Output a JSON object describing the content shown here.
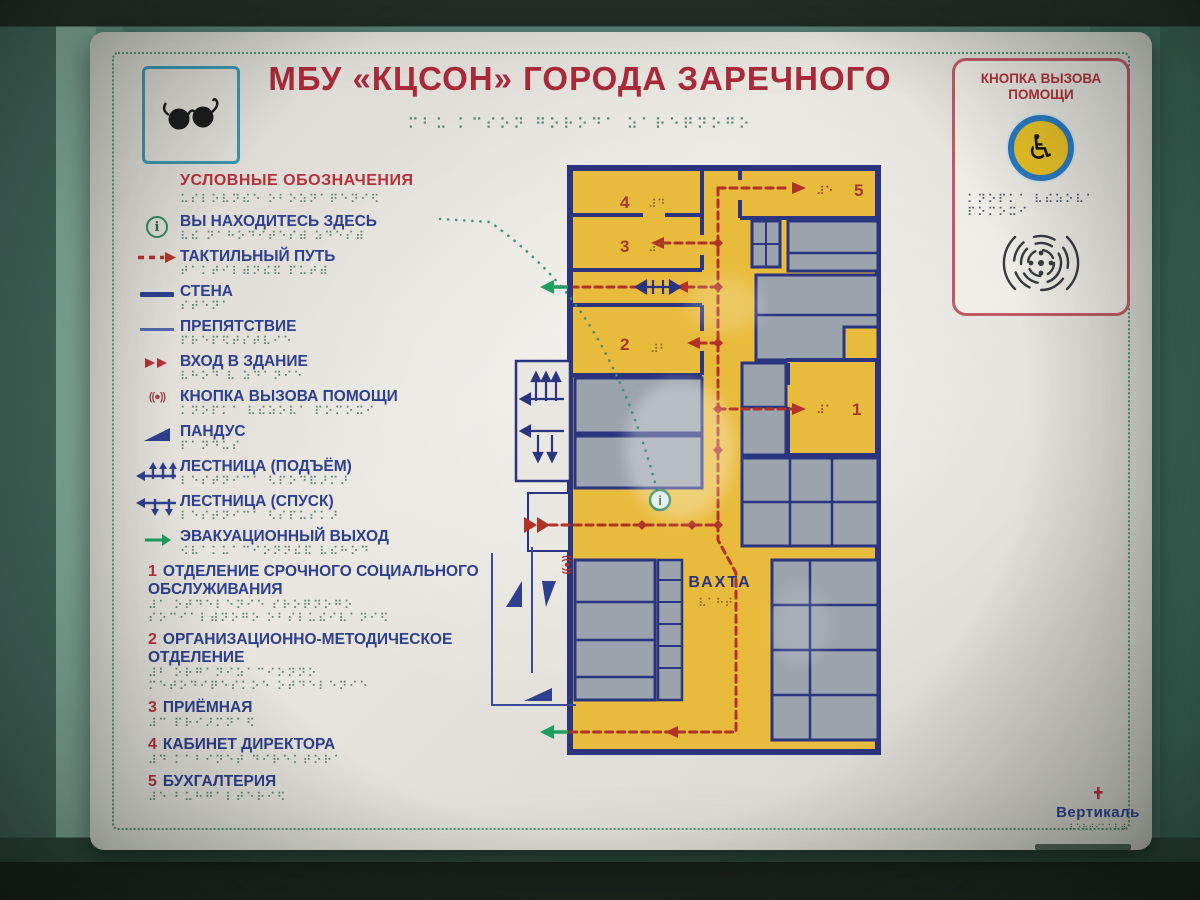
{
  "colors": {
    "wall_teal": "#5c887b",
    "board_white": "#e8e6df",
    "title_red": "#a8293a",
    "legend_blue": "#2e3f8f",
    "path_red": "#b23228",
    "plan_yellow": "#e9bb3c",
    "room_gray": "#9ba3ad",
    "wall_navy": "#2b3480",
    "exit_green": "#1f9e5d",
    "braille_teal": "#5d8277",
    "border_dotted_green": "#4e8e6e",
    "help_panel_border": "#c05a66",
    "wheel_blue": "#2b7bc4",
    "wheel_yellow": "#edc427"
  },
  "header": {
    "title": "МБУ «КЦСОН» ГОРОДА ЗАРЕЧНОГО",
    "title_braille": "⠍⠃⠥ ⠅⠉⠎⠕⠝ ⠛⠕⠗⠕⠙⠁ ⠵⠁⠗⠑⠟⠝⠕⠛⠕"
  },
  "help_panel": {
    "title_line1": "КНОПКА ВЫЗОВА",
    "title_line2": "ПОМОЩИ",
    "wheelchair_symbol": "♿",
    "braille_line1": "⠅⠝⠕⠏⠅⠁ ⠧⠮⠵⠕⠧⠁",
    "braille_line2": "⠏⠕⠍⠕⠭⠊"
  },
  "legend": {
    "header_label": "УСЛОВНЫЕ ОБОЗНАЧЕНИЯ",
    "header_braille": "⠥⠎⠇⠕⠧⠝⠮⠑ ⠕⠃⠕⠵⠝⠁⠟⠑⠝⠊⠫",
    "help_symbol": "((●))",
    "items": [
      {
        "label": "ВЫ НАХОДИТЕСЬ ЗДЕСЬ",
        "braille": "⠧⠮ ⠝⠁⠓⠕⠙⠊⠞⠑⠎⠾ ⠵⠙⠑⠎⠾"
      },
      {
        "label": "ТАКТИЛЬНЫЙ ПУТЬ",
        "braille": "⠞⠁⠅⠞⠊⠇⠾⠝⠮⠯ ⠏⠥⠞⠾"
      },
      {
        "label": "СТЕНА",
        "braille": "⠎⠞⠑⠝⠁"
      },
      {
        "label": "ПРЕПЯТСТВИЕ",
        "braille": "⠏⠗⠑⠏⠫⠞⠎⠞⠧⠊⠑"
      },
      {
        "label": "ВХОД В ЗДАНИЕ",
        "braille": "⠧⠓⠕⠙ ⠧ ⠵⠙⠁⠝⠊⠑"
      },
      {
        "label": "КНОПКА ВЫЗОВА ПОМОЩИ",
        "braille": "⠅⠝⠕⠏⠅⠁ ⠧⠮⠵⠕⠧⠁ ⠏⠕⠍⠕⠭⠊"
      },
      {
        "label": "ПАНДУС",
        "braille": "⠏⠁⠝⠙⠥⠎"
      },
      {
        "label": "ЛЕСТНИЦА (ПОДЪЁМ)",
        "braille": "⠇⠑⠎⠞⠝⠊⠉⠁ ⠣⠏⠕⠙⠯⠜⠍⠜"
      },
      {
        "label": "ЛЕСТНИЦА (СПУСК)",
        "braille": "⠇⠑⠎⠞⠝⠊⠉⠁ ⠣⠎⠏⠥⠎⠅⠜"
      },
      {
        "label": "ЭВАКУАЦИОННЫЙ ВЫХОД",
        "braille": "⠪⠧⠁⠅⠥⠁⠉⠊⠕⠝⠝⠮⠯ ⠧⠮⠓⠕⠙"
      }
    ],
    "rooms": [
      {
        "num": "1",
        "label": "ОТДЕЛЕНИЕ СРОЧНОГО СОЦИАЛЬНОГО ОБСЛУЖИВАНИЯ",
        "b1": "⠼⠁ ⠕⠞⠙⠑⠇⠑⠝⠊⠑ ⠎⠗⠕⠟⠝⠕⠛⠕",
        "b2": "⠎⠕⠉⠊⠁⠇⠾⠝⠕⠛⠕ ⠕⠃⠎⠇⠥⠮⠊⠧⠁⠝⠊⠫"
      },
      {
        "num": "2",
        "label": "ОРГАНИЗАЦИОННО-МЕТОДИЧЕСКОЕ ОТДЕЛЕНИЕ",
        "b1": "⠼⠃ ⠕⠗⠛⠁⠝⠊⠵⠁⠉⠊⠕⠝⠝⠕",
        "b2": "⠍⠑⠞⠕⠙⠊⠟⠑⠎⠅⠕⠑ ⠕⠞⠙⠑⠇⠑⠝⠊⠑"
      },
      {
        "num": "3",
        "label": "ПРИЁМНАЯ",
        "b1": "⠼⠉ ⠏⠗⠊⠜⠍⠝⠁⠫"
      },
      {
        "num": "4",
        "label": "КАБИНЕТ ДИРЕКТОРА",
        "b1": "⠼⠙ ⠅⠁⠃⠊⠝⠑⠞ ⠙⠊⠗⠑⠅⠞⠕⠗⠁"
      },
      {
        "num": "5",
        "label": "БУХГАЛТЕРИЯ",
        "b1": "⠼⠑ ⠃⠥⠓⠛⠁⠇⠞⠑⠗⠊⠫"
      }
    ]
  },
  "plan": {
    "vahta_label": "ВАХТА",
    "vahta_braille": "⠧⠁⠓⠞⠁",
    "info_symbol": "i",
    "help_button_symbol": "((●))",
    "rooms": {
      "r1": {
        "num": "1",
        "braille": "⠼⠁"
      },
      "r2": {
        "num": "2",
        "braille": "⠼⠃"
      },
      "r3": {
        "num": "3",
        "braille": "⠼⠉"
      },
      "r4": {
        "num": "4",
        "braille": "⠼⠙"
      },
      "r5": {
        "num": "5",
        "braille": "⠼⠑"
      }
    }
  },
  "logo": {
    "text": "Вертикаль",
    "braille": "⠧⠑⠗⠞⠊⠅⠁⠇⠾"
  }
}
